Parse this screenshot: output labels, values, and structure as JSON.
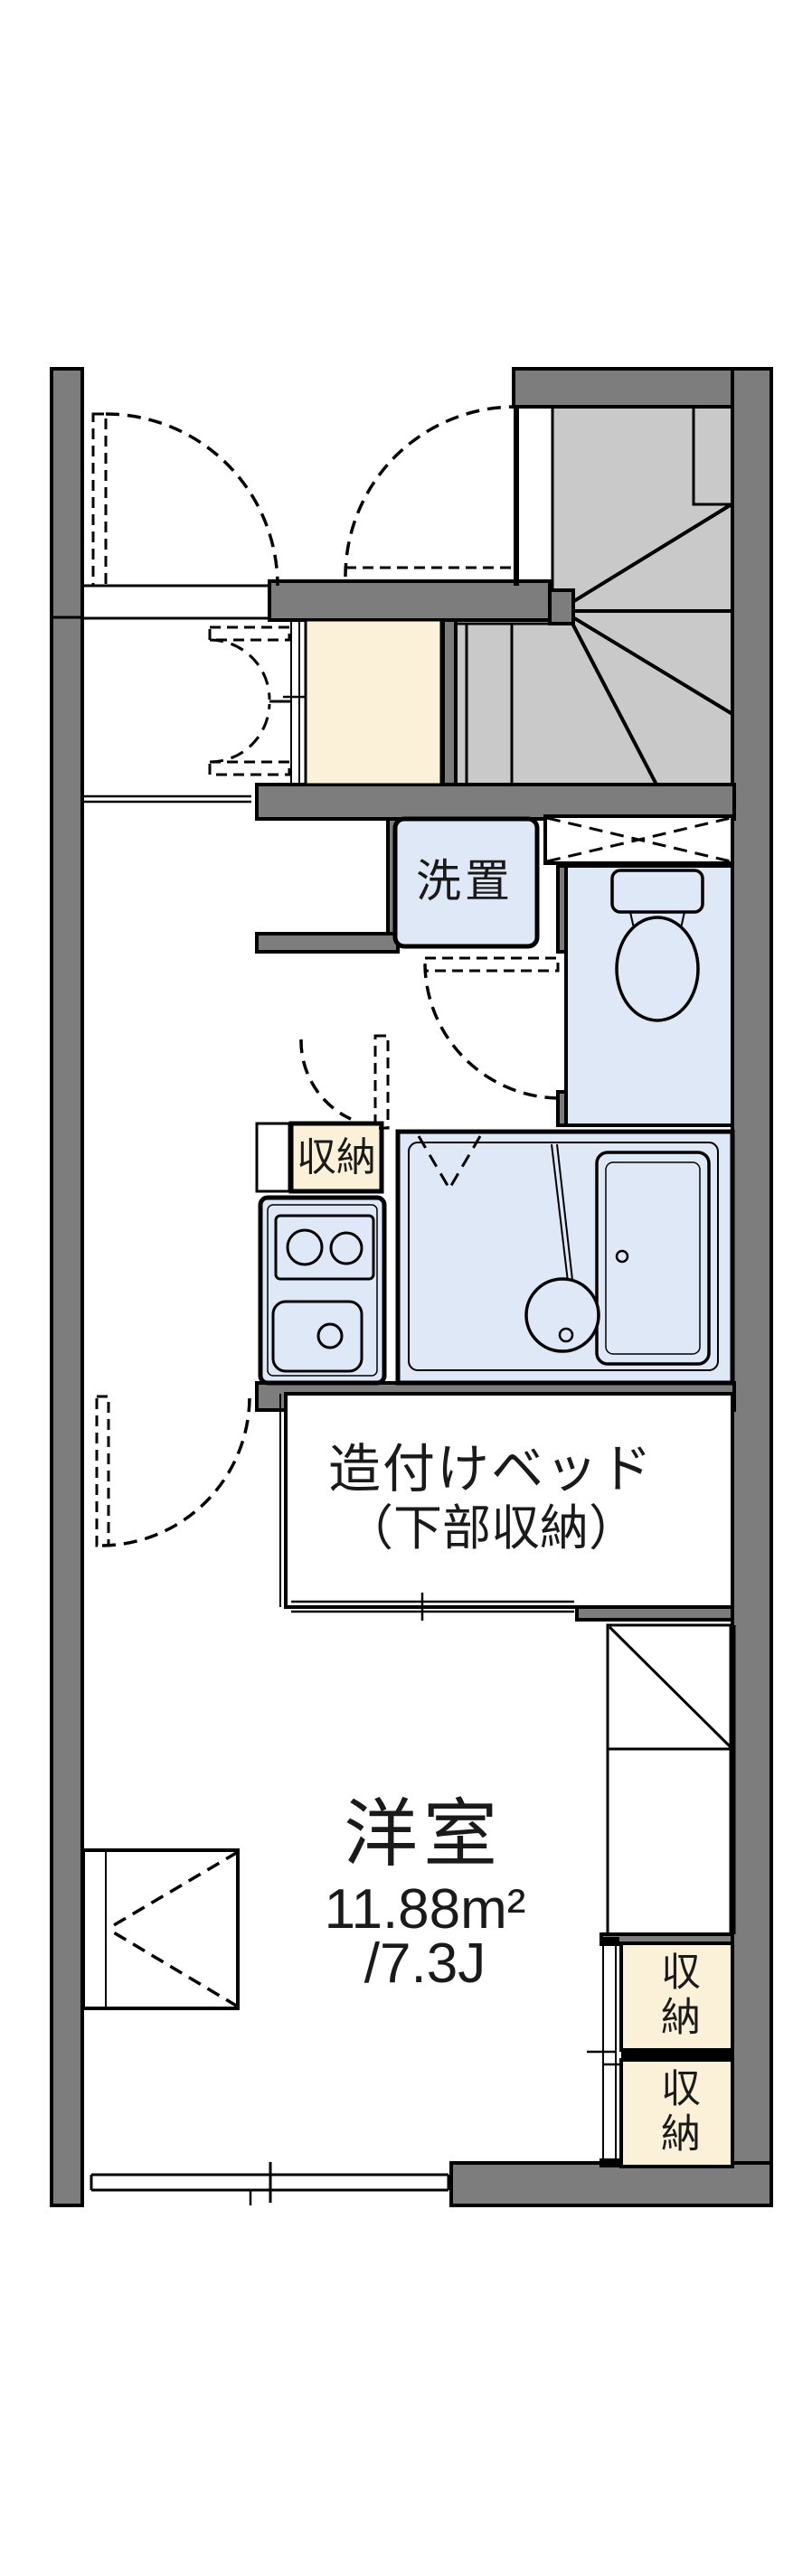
{
  "plan": {
    "type": "apartment-floor-plan",
    "labels": {
      "washer_space": "洗置",
      "kitchen_storage": "収納",
      "bed_line1": "造付けベッド",
      "bed_line2": "（下部収納）",
      "room_name": "洋室",
      "room_area_sqm": "11.88m²",
      "room_area_tatami": "/7.3J",
      "storage_upper": "収納",
      "storage_lower": "収納"
    },
    "colors": {
      "wall_gray": "#7d7d7d",
      "stairs_gray": "#c9c9c9",
      "wet_area_blue": "#dfe8f7",
      "storage_cream": "#fbf1d8",
      "line_black": "#000000",
      "background": "#ffffff"
    }
  }
}
